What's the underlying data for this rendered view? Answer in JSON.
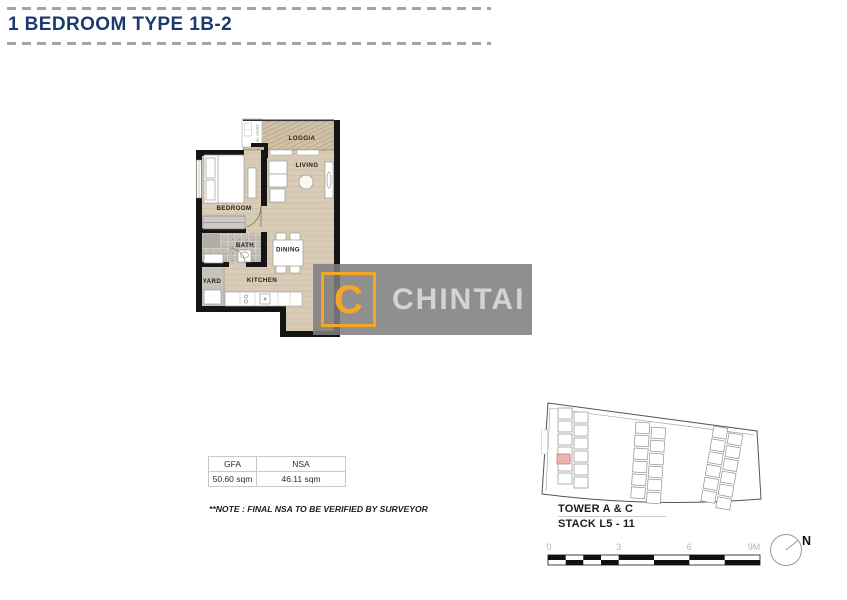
{
  "header": {
    "title": "1 BEDROOM TYPE 1B-2"
  },
  "floor_plan": {
    "labels": {
      "loggia": "LOGGIA",
      "living": "LIVING",
      "bedroom": "BEDROOM",
      "bath": "BATH",
      "dining": "DINING",
      "yard": "YARD",
      "kitchen": "KITCHEN",
      "ac_ledge": "AC LEDGE"
    }
  },
  "logo": {
    "letter": "C",
    "brand": "CHINTAI"
  },
  "area_table": {
    "columns": [
      "GFA",
      "NSA"
    ],
    "row": [
      "50.60 sqm",
      "46.11 sqm"
    ]
  },
  "note": "**NOTE : FINAL NSA TO BE VERIFIED BY SURVEYOR",
  "key_plan": {
    "tower_label": "TOWER A & C",
    "stack_label": "STACK L5 - 11",
    "scale_ticks": [
      "0",
      "3",
      "6",
      "9M"
    ],
    "north_label": "N"
  },
  "colors": {
    "title_navy": "#1d3a70",
    "accent_orange": "#F6A624",
    "floor_tan": "#d9ccb7",
    "wall_black": "#151515",
    "logo_gray": "#7e7e7e",
    "highlight_pink": "#EDB3AE"
  }
}
